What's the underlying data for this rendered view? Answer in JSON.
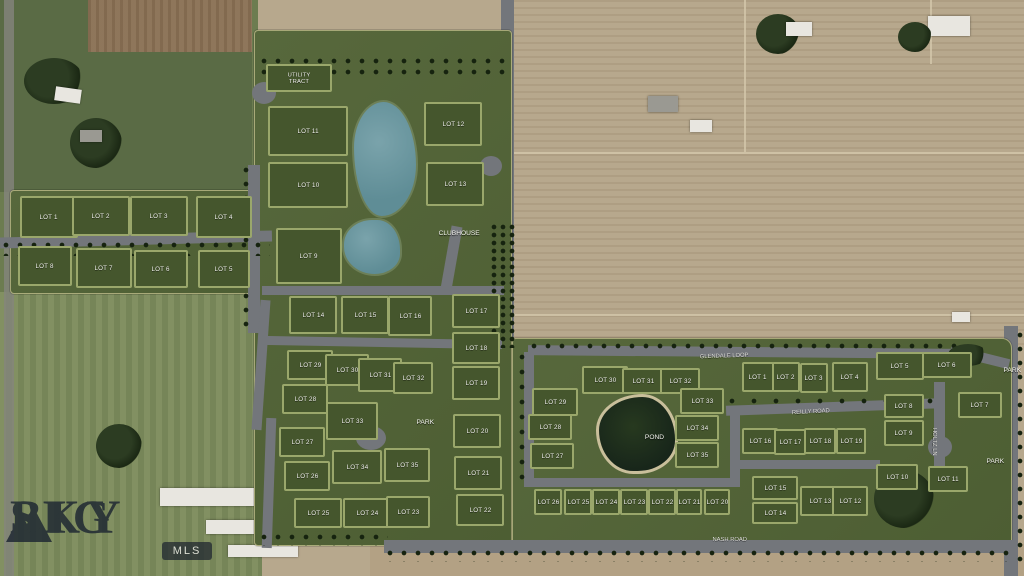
{
  "watermark": {
    "word1": "BIG",
    "word2": "SKY",
    "badge": "MLS"
  },
  "colors": {
    "overlay_green": "#54653a",
    "lot_green": "#45562d",
    "path_green": "#9aa76b",
    "pond_teal": "#6a99a1",
    "pond_dark": "#1d2b1c",
    "road_gray": "#73767b",
    "field_tan": "#b7a88d"
  },
  "map": {
    "road_labels": [
      {
        "text": "GLENDALE LOOP",
        "x": 682,
        "y": 352,
        "rot": -2
      },
      {
        "text": "REILLY ROAD",
        "x": 778,
        "y": 408,
        "rot": -3
      },
      {
        "text": "HOLTZ LN",
        "x": 940,
        "y": 418,
        "rot": 90
      },
      {
        "text": "NASH ROAD",
        "x": 700,
        "y": 534,
        "rot": 0
      }
    ],
    "area_labels": [
      {
        "text": "CLUBHOUSE",
        "x": 428,
        "y": 228
      },
      {
        "text": "PARK",
        "x": 412,
        "y": 417
      },
      {
        "text": "POND",
        "x": 640,
        "y": 432
      },
      {
        "text": "PARK",
        "x": 982,
        "y": 456
      },
      {
        "text": "PARK",
        "x": 999,
        "y": 365
      }
    ],
    "sections": [
      {
        "name": "west",
        "lots": [
          {
            "label": "LOT 1",
            "x": 20,
            "y": 196,
            "w": 58,
            "h": 42
          },
          {
            "label": "LOT 2",
            "x": 72,
            "y": 196,
            "w": 58,
            "h": 40
          },
          {
            "label": "LOT 3",
            "x": 130,
            "y": 196,
            "w": 58,
            "h": 40
          },
          {
            "label": "LOT 4",
            "x": 196,
            "y": 196,
            "w": 56,
            "h": 42
          },
          {
            "label": "LOT 8",
            "x": 18,
            "y": 246,
            "w": 54,
            "h": 40
          },
          {
            "label": "LOT 7",
            "x": 76,
            "y": 248,
            "w": 56,
            "h": 40
          },
          {
            "label": "LOT 6",
            "x": 134,
            "y": 250,
            "w": 54,
            "h": 38
          },
          {
            "label": "LOT 5",
            "x": 198,
            "y": 250,
            "w": 52,
            "h": 38
          }
        ]
      },
      {
        "name": "central",
        "lots": [
          {
            "label": "UTILITY TRACT",
            "x": 266,
            "y": 64,
            "w": 66,
            "h": 28,
            "wrap": true
          },
          {
            "label": "LOT 11",
            "x": 268,
            "y": 106,
            "w": 80,
            "h": 50
          },
          {
            "label": "LOT 12",
            "x": 424,
            "y": 102,
            "w": 58,
            "h": 44
          },
          {
            "label": "LOT 10",
            "x": 268,
            "y": 162,
            "w": 80,
            "h": 46
          },
          {
            "label": "LOT 13",
            "x": 426,
            "y": 162,
            "w": 58,
            "h": 44
          },
          {
            "label": "LOT 9",
            "x": 276,
            "y": 228,
            "w": 66,
            "h": 56
          },
          {
            "label": "LOT 14",
            "x": 289,
            "y": 296,
            "w": 48,
            "h": 38
          },
          {
            "label": "LOT 15",
            "x": 341,
            "y": 296,
            "w": 48,
            "h": 38
          },
          {
            "label": "LOT 16",
            "x": 388,
            "y": 296,
            "w": 44,
            "h": 40
          },
          {
            "label": "LOT 17",
            "x": 452,
            "y": 294,
            "w": 48,
            "h": 34
          },
          {
            "label": "LOT 18",
            "x": 452,
            "y": 332,
            "w": 48,
            "h": 32
          },
          {
            "label": "LOT 19",
            "x": 452,
            "y": 366,
            "w": 48,
            "h": 34
          },
          {
            "label": "LOT 29",
            "x": 287,
            "y": 350,
            "w": 46,
            "h": 30
          },
          {
            "label": "LOT 30",
            "x": 325,
            "y": 354,
            "w": 44,
            "h": 32
          },
          {
            "label": "LOT 31",
            "x": 358,
            "y": 358,
            "w": 44,
            "h": 34
          },
          {
            "label": "LOT 32",
            "x": 393,
            "y": 362,
            "w": 40,
            "h": 32
          },
          {
            "label": "LOT 28",
            "x": 282,
            "y": 384,
            "w": 46,
            "h": 30
          },
          {
            "label": "LOT 33",
            "x": 326,
            "y": 402,
            "w": 52,
            "h": 38
          },
          {
            "label": "LOT 27",
            "x": 279,
            "y": 427,
            "w": 46,
            "h": 30
          },
          {
            "label": "LOT 34",
            "x": 332,
            "y": 450,
            "w": 50,
            "h": 34
          },
          {
            "label": "LOT 35",
            "x": 384,
            "y": 448,
            "w": 46,
            "h": 34
          },
          {
            "label": "LOT 20",
            "x": 453,
            "y": 414,
            "w": 48,
            "h": 34
          },
          {
            "label": "LOT 26",
            "x": 284,
            "y": 461,
            "w": 46,
            "h": 30
          },
          {
            "label": "LOT 21",
            "x": 454,
            "y": 456,
            "w": 48,
            "h": 34
          },
          {
            "label": "LOT 25",
            "x": 294,
            "y": 498,
            "w": 48,
            "h": 30
          },
          {
            "label": "LOT 24",
            "x": 343,
            "y": 498,
            "w": 48,
            "h": 30
          },
          {
            "label": "LOT 23",
            "x": 386,
            "y": 496,
            "w": 44,
            "h": 32
          },
          {
            "label": "LOT 22",
            "x": 456,
            "y": 494,
            "w": 48,
            "h": 32
          }
        ]
      },
      {
        "name": "east",
        "lots": [
          {
            "label": "LOT 30",
            "x": 582,
            "y": 366,
            "w": 46,
            "h": 28
          },
          {
            "label": "LOT 31",
            "x": 622,
            "y": 368,
            "w": 42,
            "h": 26
          },
          {
            "label": "LOT 32",
            "x": 660,
            "y": 368,
            "w": 40,
            "h": 26
          },
          {
            "label": "LOT 29",
            "x": 532,
            "y": 388,
            "w": 46,
            "h": 28
          },
          {
            "label": "LOT 28",
            "x": 528,
            "y": 414,
            "w": 44,
            "h": 26
          },
          {
            "label": "LOT 27",
            "x": 530,
            "y": 443,
            "w": 44,
            "h": 26
          },
          {
            "label": "LOT 33",
            "x": 680,
            "y": 388,
            "w": 44,
            "h": 26
          },
          {
            "label": "LOT 34",
            "x": 675,
            "y": 415,
            "w": 44,
            "h": 26
          },
          {
            "label": "LOT 35",
            "x": 675,
            "y": 442,
            "w": 44,
            "h": 26
          },
          {
            "label": "LOT 1",
            "x": 742,
            "y": 362,
            "w": 32,
            "h": 30
          },
          {
            "label": "LOT 2",
            "x": 772,
            "y": 362,
            "w": 28,
            "h": 30
          },
          {
            "label": "LOT 3",
            "x": 800,
            "y": 363,
            "w": 28,
            "h": 30
          },
          {
            "label": "LOT 4",
            "x": 832,
            "y": 362,
            "w": 36,
            "h": 30
          },
          {
            "label": "LOT 5",
            "x": 876,
            "y": 352,
            "w": 48,
            "h": 28
          },
          {
            "label": "LOT 6",
            "x": 922,
            "y": 352,
            "w": 50,
            "h": 26
          },
          {
            "label": "LOT 8",
            "x": 884,
            "y": 394,
            "w": 40,
            "h": 24
          },
          {
            "label": "LOT 7",
            "x": 958,
            "y": 392,
            "w": 44,
            "h": 26
          },
          {
            "label": "LOT 9",
            "x": 884,
            "y": 420,
            "w": 40,
            "h": 26
          },
          {
            "label": "LOT 16",
            "x": 742,
            "y": 428,
            "w": 36,
            "h": 26
          },
          {
            "label": "LOT 17",
            "x": 774,
            "y": 429,
            "w": 32,
            "h": 26
          },
          {
            "label": "LOT 18",
            "x": 804,
            "y": 428,
            "w": 32,
            "h": 26
          },
          {
            "label": "LOT 19",
            "x": 836,
            "y": 428,
            "w": 30,
            "h": 26
          },
          {
            "label": "LOT 10",
            "x": 876,
            "y": 464,
            "w": 42,
            "h": 26
          },
          {
            "label": "LOT 11",
            "x": 928,
            "y": 466,
            "w": 40,
            "h": 26
          },
          {
            "label": "LOT 15",
            "x": 752,
            "y": 476,
            "w": 46,
            "h": 24
          },
          {
            "label": "LOT 14",
            "x": 752,
            "y": 502,
            "w": 46,
            "h": 22
          },
          {
            "label": "LOT 13",
            "x": 800,
            "y": 486,
            "w": 40,
            "h": 30
          },
          {
            "label": "LOT 12",
            "x": 832,
            "y": 486,
            "w": 36,
            "h": 30
          },
          {
            "label": "LOT 26",
            "x": 534,
            "y": 489,
            "w": 28,
            "h": 26
          },
          {
            "label": "LOT 25",
            "x": 564,
            "y": 489,
            "w": 28,
            "h": 26
          },
          {
            "label": "LOT 24",
            "x": 592,
            "y": 489,
            "w": 28,
            "h": 26
          },
          {
            "label": "LOT 23",
            "x": 620,
            "y": 489,
            "w": 28,
            "h": 26
          },
          {
            "label": "LOT 22",
            "x": 648,
            "y": 489,
            "w": 28,
            "h": 26
          },
          {
            "label": "LOT 21",
            "x": 676,
            "y": 489,
            "w": 26,
            "h": 26
          },
          {
            "label": "LOT 20",
            "x": 704,
            "y": 489,
            "w": 26,
            "h": 26
          }
        ]
      }
    ]
  }
}
